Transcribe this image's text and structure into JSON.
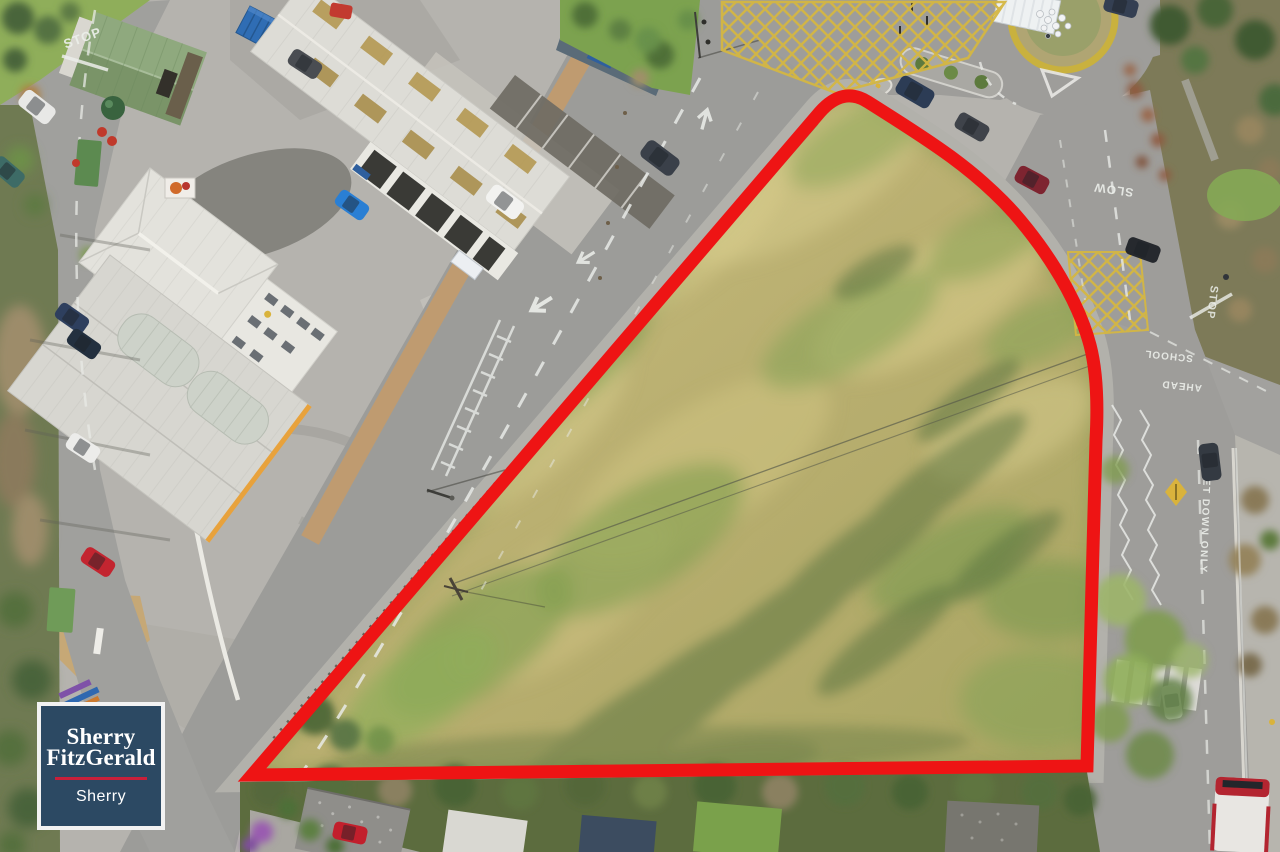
{
  "watermark": {
    "brand_line1": "Sherry",
    "brand_line2": "FitzGerald",
    "office": "Sherry",
    "background_color": "#2c4963",
    "divider_color": "#c81f3a",
    "text_color": "#ffffff"
  },
  "site_boundary": {
    "color": "#ee1414",
    "stroke_width": 13
  },
  "road_markings": {
    "stop_top_left": "STOP",
    "slow": "SLOW",
    "stop_school_junction": "STOP",
    "school": "SCHOOL",
    "ahead": "AHEAD",
    "set_down_only": "SET DOWN ONLY"
  }
}
